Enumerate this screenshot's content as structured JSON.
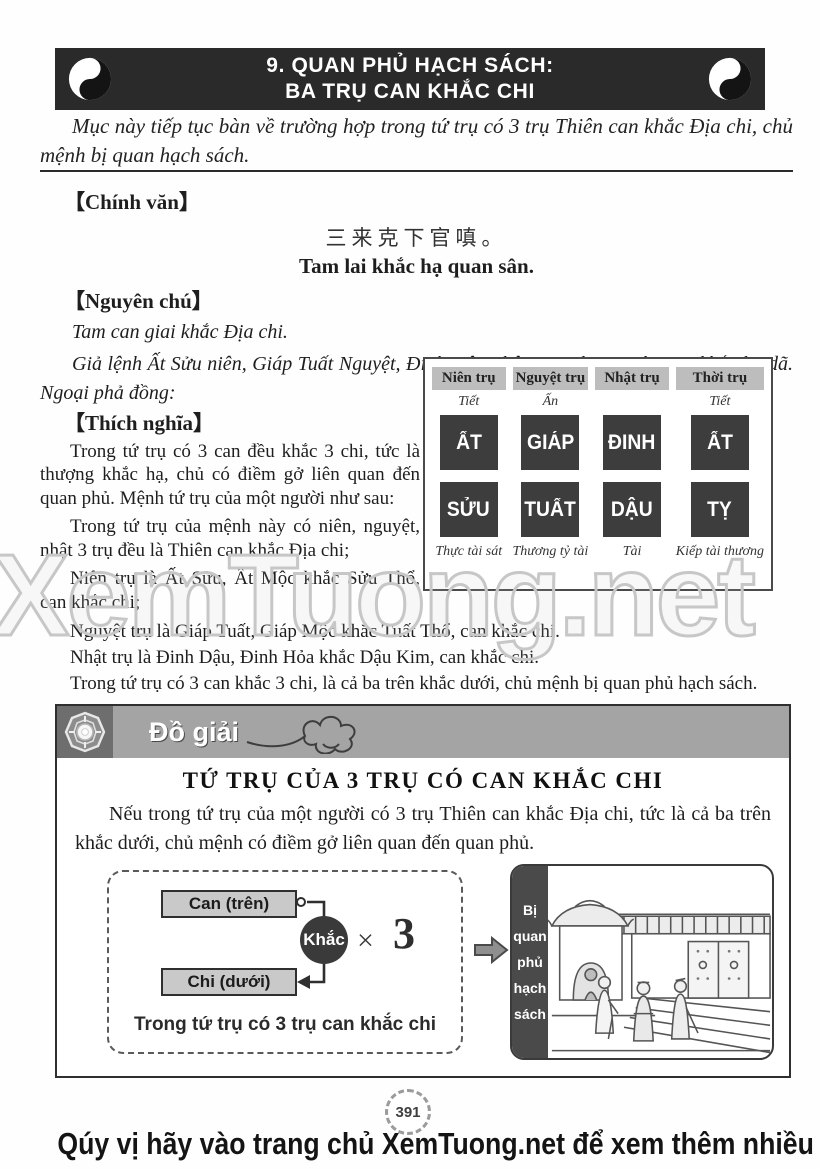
{
  "colors": {
    "banner_bg": "#2a2a2a",
    "pillar_dark": "#3d3d3d",
    "header_cell_gray": "#bdbdbd",
    "section_bar_gray": "#a4a4a4",
    "watermark_gray": "#c7c7c7"
  },
  "header": {
    "title_line1": "9. QUAN PHỦ HẠCH SÁCH:",
    "title_line2": "BA TRỤ CAN KHẮC CHI"
  },
  "intro": {
    "text": "Mục này tiếp tục bàn về trường hợp trong tứ trụ có 3 trụ Thiên can khắc Địa chi, chủ mệnh bị quan hạch sách."
  },
  "chinh_van": {
    "label": "【Chính văn】",
    "chinese": "三来克下官嗔。",
    "transliteration": "Tam lai khắc hạ quan sân."
  },
  "nguyen_chu": {
    "label": "【Nguyên chú】",
    "para1": "Tam can giai khắc Địa chi.",
    "para2": "Giả lệnh Ất Sửu niên, Giáp Tuất Nguyệt, Đinh Dậu nhật, giai thị tam thượng khắc hạ dã. Ngoại phả đồng:"
  },
  "thich_nghia": {
    "label": "【Thích nghĩa】",
    "paras": [
      "Trong tứ trụ có 3 can đều khắc 3 chi, tức là thượng khắc hạ, chủ có điềm gở liên quan đến quan phủ. Mệnh tứ trụ của một người như sau:",
      "Trong tứ trụ của mệnh này có niên, nguyệt, nhật 3 trụ đều là Thiên can khắc Địa chi;",
      "Niên trụ là Ất Sửu, Ất Mộc khắc Sửu Thổ, can khắc chi;",
      "Nguyệt trụ là Giáp Tuất, Giáp Mộc khắc Tuất Thổ, can khắc chi.",
      "Nhật trụ là Đinh Dậu, Đinh Hỏa khắc Dậu Kim, can khắc chi.",
      "Trong tứ trụ có 3 can khắc 3 chi, là cả ba trên khắc dưới, chủ mệnh bị quan phủ hạch sách."
    ]
  },
  "pillar_table": {
    "columns": [
      {
        "header": "Niên trụ",
        "god_top": "Tiết",
        "can": "ẤT",
        "chi": "SỬU",
        "god_bottom": "Thực tài sát"
      },
      {
        "header": "Nguyệt trụ",
        "god_top": "Ấn",
        "can": "GIÁP",
        "chi": "TUẤT",
        "god_bottom": "Thương tỷ tài"
      },
      {
        "header": "Nhật trụ",
        "god_top": "",
        "can": "ĐINH",
        "chi": "DẬU",
        "god_bottom": "Tài"
      },
      {
        "header": "Thời trụ",
        "god_top": "Tiết",
        "can": "ẤT",
        "chi": "TỴ",
        "god_bottom": "Kiếp tài thương"
      }
    ]
  },
  "watermark": {
    "text": "XemTuong.net"
  },
  "do_giai": {
    "label": "Đồ giải",
    "title": "TỨ TRỤ CỦA 3 TRỤ CÓ CAN KHẮC CHI",
    "paragraph": "Nếu trong tứ trụ của một người có 3 trụ Thiên can khắc Địa chi, tức là cả ba trên khắc dưới, chủ mệnh có điềm gở liên quan đến quan phủ.",
    "diagram": {
      "can_label": "Can (trên)",
      "khac_label": "Khắc",
      "times_sign": "×",
      "multiplier": "3",
      "chi_label": "Chi (dưới)",
      "caption": "Trong tứ trụ có 3 trụ can khắc chi",
      "result_words": [
        "Bị",
        "quan",
        "phủ",
        "hạch",
        "sách"
      ]
    }
  },
  "page_number": "391",
  "footer": {
    "text": "Qúy vị hãy vào trang chủ XemTuong.net để xem thêm nhiều mục hay khác"
  }
}
